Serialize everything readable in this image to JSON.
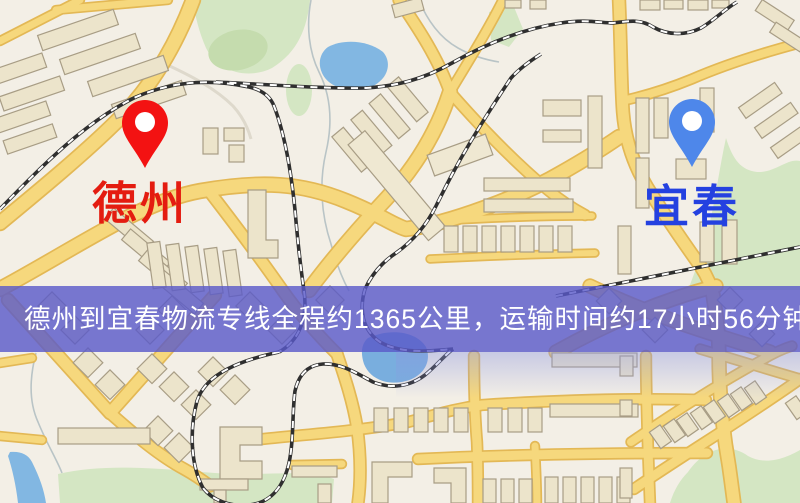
{
  "route": {
    "origin": "德州",
    "destination": "宜春",
    "banner_text": "德州到宜春物流专线全程约1365公里，运输时间约17小时56分钟.",
    "distance_text": "约1365公里",
    "duration_text": "约17小时56分钟"
  },
  "markers": {
    "origin": {
      "label": "德州",
      "pin_icon": "map-pin-icon",
      "pin_color": "#f31212",
      "label_color": "#e41c10"
    },
    "destination": {
      "label": "宜春",
      "pin_icon": "map-pin-icon",
      "pin_color": "#4e87ea",
      "label_color": "#2441e0"
    }
  },
  "banner": {
    "background": "#5a5ac9",
    "text_color": "#ffffff"
  },
  "map_palette": {
    "background": "#f3efe6",
    "road_fill": "#f6d87d",
    "road_casing": "#e3b855",
    "water": "#82b7e2",
    "park": "#d4e6c3",
    "building": "#ece4cb",
    "railway": "#2f2f2f"
  }
}
